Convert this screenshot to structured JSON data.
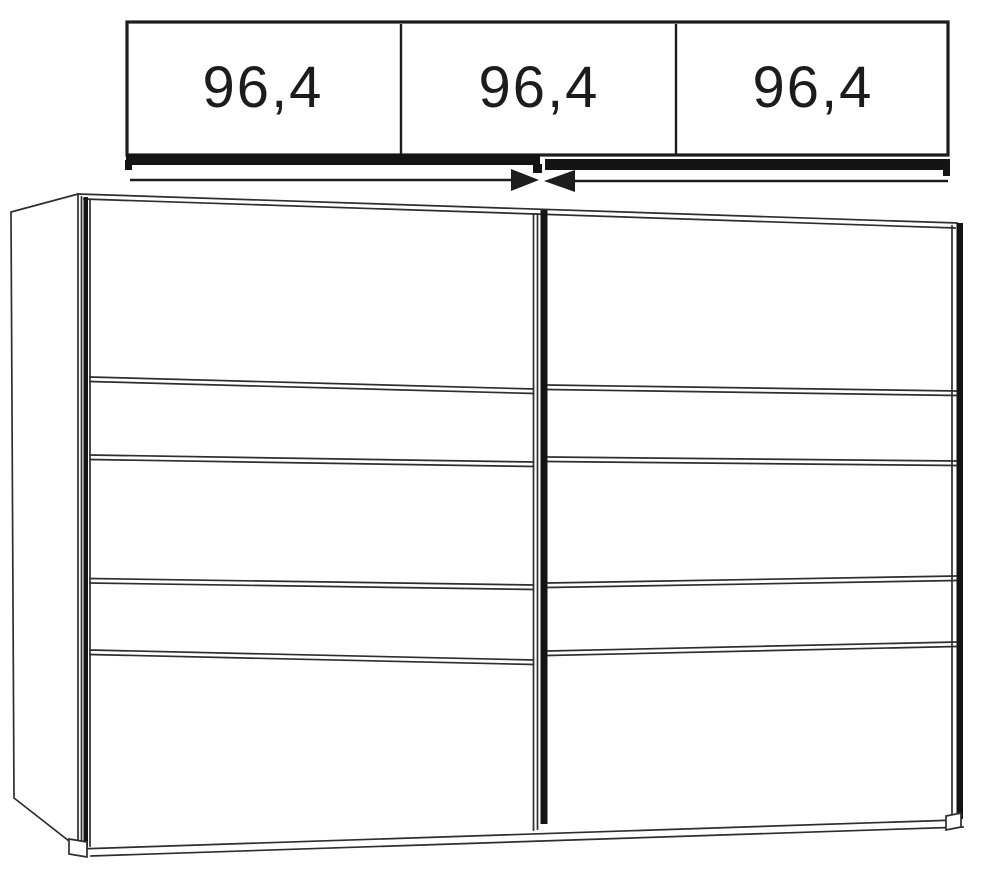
{
  "diagram": {
    "type": "furniture-technical-drawing",
    "subject": "Two-door sliding wardrobe line drawing with door width dimension panel above",
    "dimension_labels": [
      "96,4",
      "96,4",
      "96,4"
    ],
    "doors": 2,
    "panels_per_door": 5,
    "icons": {
      "arrow_right": "right-pointing solid triangle",
      "arrow_left": "left-pointing solid triangle"
    },
    "colors": {
      "line": "#1d1d1d",
      "thin_line": "#2e2e2e",
      "fill_thick": "#141414",
      "background": "#ffffff",
      "text": "#1c1c1c"
    }
  }
}
